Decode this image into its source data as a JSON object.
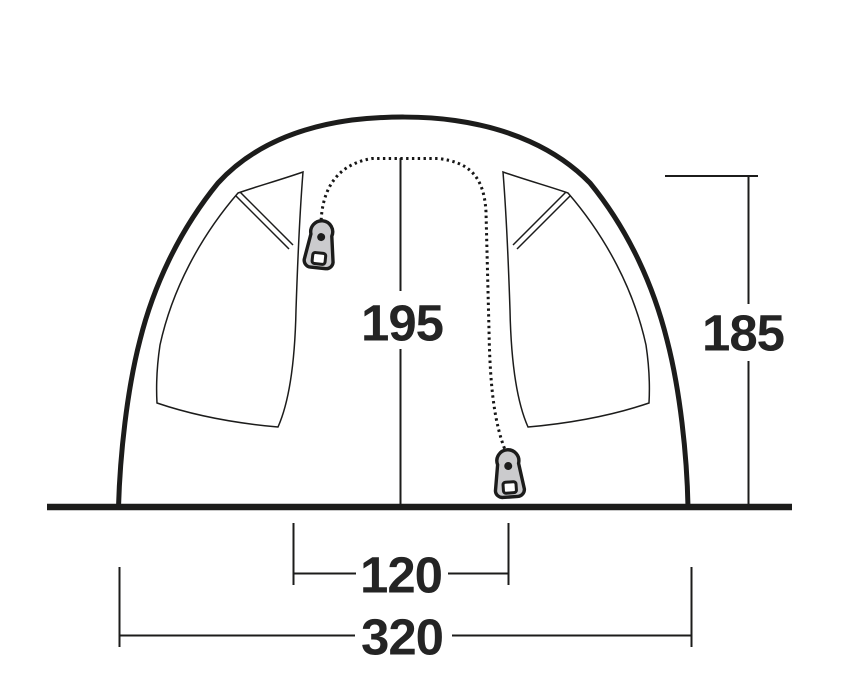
{
  "diagram": {
    "name": "tent-front-elevation-dimension-diagram",
    "dimensions": {
      "inner_height": "195",
      "side_height": "185",
      "door_width": "120",
      "base_width": "320"
    },
    "colors": {
      "line": "#1c1c1b",
      "text": "#242424",
      "zipper_pull_fill": "#cbcbcd",
      "background": "#ffffff"
    }
  }
}
